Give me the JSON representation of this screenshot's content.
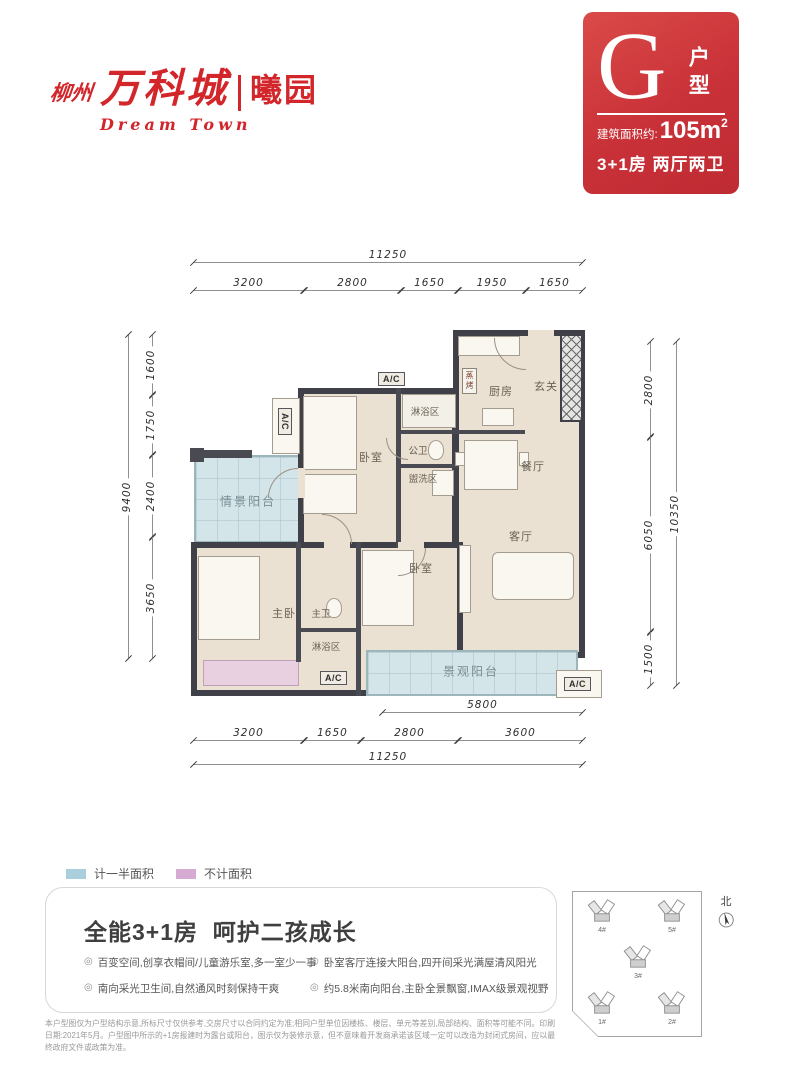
{
  "logo": {
    "prefix": "柳州",
    "name": "万科城",
    "sub": "曦园",
    "script": "Dream Town"
  },
  "badge": {
    "letter": "G",
    "type_label": "户型",
    "area_prefix": "建筑面积约:",
    "area_value": "105m",
    "area_sup": "2",
    "spec": "3+1房 两厅两卫"
  },
  "plan": {
    "rooms": [
      {
        "label": "玄关"
      },
      {
        "label": "厨房"
      },
      {
        "label": "餐厅"
      },
      {
        "label": "客厅"
      },
      {
        "label": "卧室"
      },
      {
        "label": "淋浴区"
      },
      {
        "label": "公卫"
      },
      {
        "label": "盥洗区"
      },
      {
        "label": "情景阳台"
      },
      {
        "label": "主卧"
      },
      {
        "label": "主卫"
      },
      {
        "label": "淋浴区"
      },
      {
        "label": "卧室"
      },
      {
        "label": "景观阳台"
      }
    ],
    "ac_units": [
      "A/C",
      "A/C",
      "A/C",
      "A/C"
    ],
    "appliance": "蒸烤",
    "dims": {
      "top_overall": "11250",
      "top_segments": [
        "3200",
        "2800",
        "1650",
        "1950",
        "1650"
      ],
      "bottom_upper": "5800",
      "bottom_segments": [
        "3200",
        "1650",
        "2800",
        "3600"
      ],
      "bottom_overall": "11250",
      "left_segments": [
        "1600",
        "1750",
        "2400",
        "3650"
      ],
      "left_overall": "9400",
      "right_segments": [
        "2800",
        "6050",
        "1500"
      ],
      "right_overall": "10350"
    }
  },
  "legend": {
    "items": [
      {
        "label": "计一半面积",
        "color": "#a9cfdd"
      },
      {
        "label": "不计面积",
        "color": "#d5abd3"
      }
    ]
  },
  "info": {
    "title": "全能3+1房  呵护二孩成长",
    "marker": "◎",
    "bullets_left": [
      "百变空间,创享衣帽间/儿童游乐室,多一室少一事",
      "南向采光卫生间,自然通风时刻保持干爽"
    ],
    "bullets_right": [
      "卧室客厅连接大阳台,四开间采光满屋清风阳光",
      "约5.8米南向阳台,主卧全景飘窗,IMAX级景观视野"
    ],
    "disclaimer": "本户型图仅为户型结构示意,所标尺寸仅供参考,交房尺寸以合同约定为准;相同户型单位因楼栋、楼层、单元等差别,局部结构、面积等可能不同。印刷日期:2021年5月。户型图中所示的+1房报建时为露台或阳台，图示仅为装修示意，但不意味着开发商承诺该区域一定可以改造为封闭式房间，应以最终政府文件或政策为准。"
  },
  "siteplan": {
    "buildings": [
      "4#",
      "5#",
      "3#",
      "1#",
      "2#"
    ],
    "north_label": "北"
  },
  "colors": {
    "brand_red": "#d2262b",
    "badge_red": "#c93138",
    "wall_dark": "#404148",
    "balcony_blue": "#d3e5e9",
    "legend_blue": "#a9cfdd",
    "bay_pink": "#e8d0e0",
    "legend_pink": "#d5abd3"
  }
}
